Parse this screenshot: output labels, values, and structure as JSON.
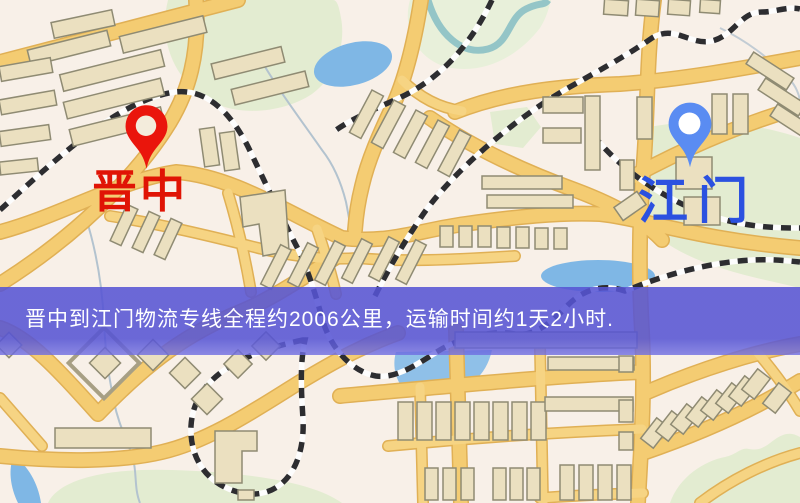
{
  "route_banner": {
    "text": "晋中到江门物流专线全程约2006公里，运输时间约1天2小时.",
    "bg_color": "#5654d4",
    "text_color": "#ffffff"
  },
  "origin": {
    "label": "晋中",
    "label_color": "#e01405",
    "pin_color": "#ea150c"
  },
  "destination": {
    "label": "江门",
    "label_color": "#2b51e0",
    "pin_color": "#5a8cf2"
  },
  "route": {
    "origin_city": "晋中",
    "destination_city": "江门",
    "distance_km": "2006",
    "duration": "1天2小时"
  },
  "map_colors": {
    "background": "#f8f0e8",
    "park": "#e3ecd1",
    "water": "#7fb7e5",
    "river": "#94c5c7",
    "road_fill": "#f4cc72",
    "road_casing": "#e0b055",
    "building": "#ebe0c0",
    "building_outline": "#8f8b73",
    "railway": "#2d2d30"
  }
}
